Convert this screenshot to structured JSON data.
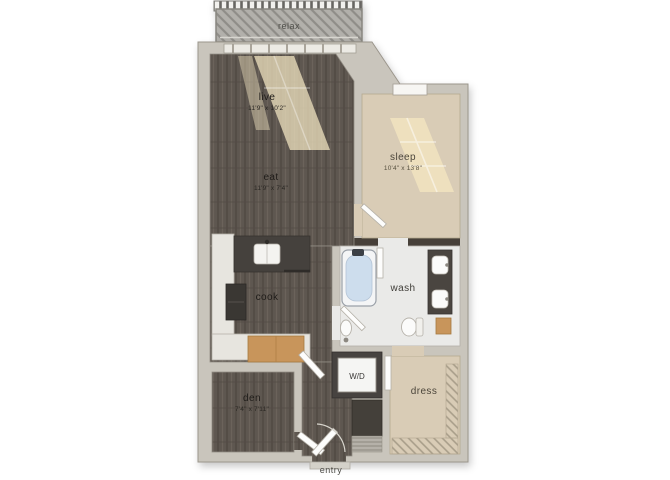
{
  "plan": {
    "rooms": {
      "relax": {
        "label": "relax"
      },
      "live": {
        "label": "live",
        "dims": "11'9\" x 10'2\""
      },
      "eat": {
        "label": "eat",
        "dims": "11'9\" x 7'4\""
      },
      "sleep": {
        "label": "sleep",
        "dims": "10'4\" x 13'8\""
      },
      "cook": {
        "label": "cook"
      },
      "wash": {
        "label": "wash"
      },
      "laundry": {
        "label": "W/D"
      },
      "den": {
        "label": "den",
        "dims": "7'4\" x 7'11\""
      },
      "dress": {
        "label": "dress"
      },
      "entry": {
        "label": "entry"
      }
    },
    "colors": {
      "wall": "#c9c5bc",
      "wood": "#5e5750",
      "carpet": "#d9ccb6",
      "tile": "#eaeae8",
      "sunlight": "#efe2bf",
      "counter_dark": "#45413d",
      "cabinet_wood": "#c8955b",
      "tub_water": "#cddded",
      "balcony": "#b2b0ab",
      "accent_dark_wall": "#474039"
    }
  }
}
